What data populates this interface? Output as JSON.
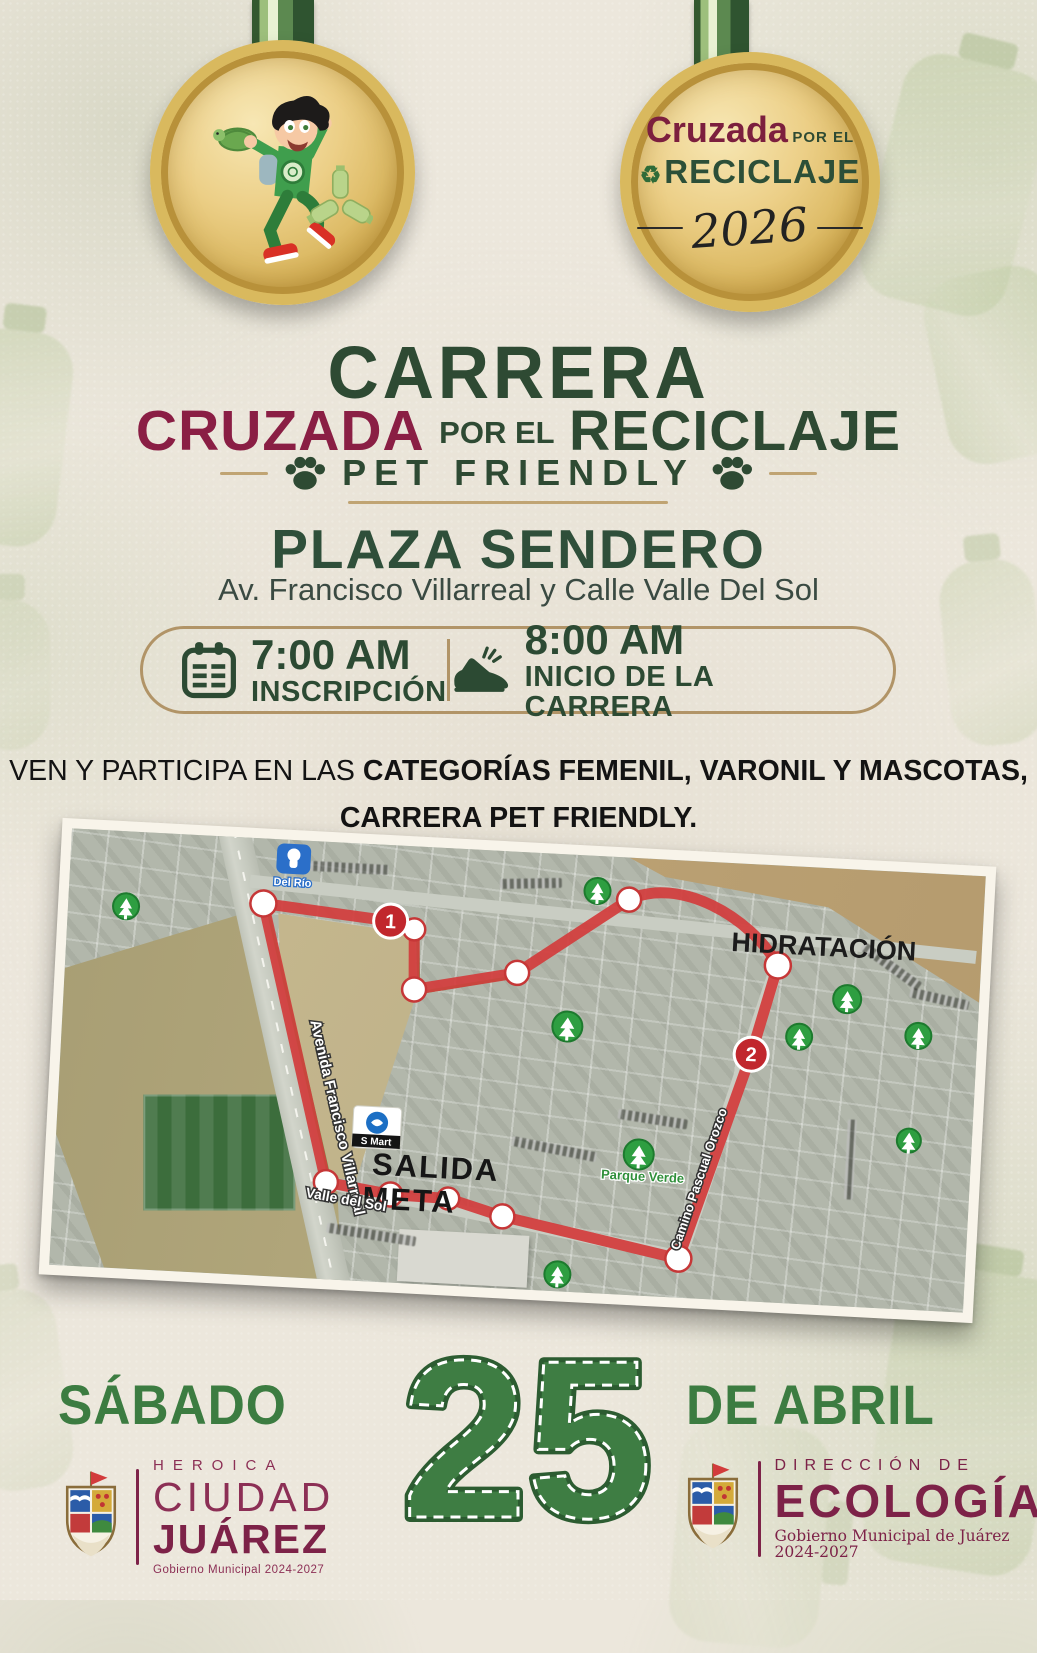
{
  "medal_right": {
    "brand_a": "Cruzada",
    "brand_b": "POR EL",
    "brand_c": "RECICLAJE",
    "recycle_glyph": "♻",
    "year": "2026"
  },
  "title": {
    "main": "CARRERA",
    "sub_a": "CRUZADA",
    "sub_b": "POR EL",
    "sub_c": "RECICLAJE",
    "pet_friendly": "PET FRIENDLY"
  },
  "venue": {
    "name": "PLAZA SENDERO",
    "address": "Av. Francisco Villarreal y Calle Valle Del Sol"
  },
  "schedule": {
    "registration_time": "7:00 AM",
    "registration_label": "INSCRIPCIÓN",
    "start_time": "8:00 AM",
    "start_label": "INICIO DE LA CARRERA"
  },
  "invite": {
    "prefix": "VEN Y PARTICIPA EN LAS ",
    "categories": "CATEGORÍAS FEMENIL, VARONIL Y MASCOTAS,",
    "line2": "CARRERA PET FRIENDLY."
  },
  "map": {
    "hydration_label": "HIDRATACIÓN",
    "start_finish_line1": "SALIDA",
    "start_finish_line2": "META",
    "park_label": "Parque Verde",
    "street_avenida": "Avenida Francisco Villarreal",
    "street_valle": "Valle del Sol",
    "street_camino": "Camino Pascual Orozco",
    "store_smart": "S Mart",
    "store_delrio": "Del Río",
    "marker1": "1",
    "marker2": "2"
  },
  "date": {
    "day": "SÁBADO",
    "number": "25",
    "month": "DE ABRIL"
  },
  "footer": {
    "left": {
      "heroica": "HEROICA",
      "city_thin": "CIUDAD",
      "city_bold": "JUÁREZ",
      "gov": "Gobierno Municipal 2024-2027"
    },
    "right": {
      "direccion": "DIRECCIÓN DE",
      "name": "ECOLOGÍA",
      "gov": "Gobierno Municipal de Juárez 2024-2027"
    }
  },
  "colors": {
    "dark_green": "#2e4a33",
    "maroon": "#8a1e44",
    "footer_maroon": "#7d2248",
    "date_green": "#3c7c41",
    "gold": "#d9b95e",
    "route_red": "#d23c3c",
    "tan_line": "#c0a473",
    "paper": "#ece7dc"
  }
}
